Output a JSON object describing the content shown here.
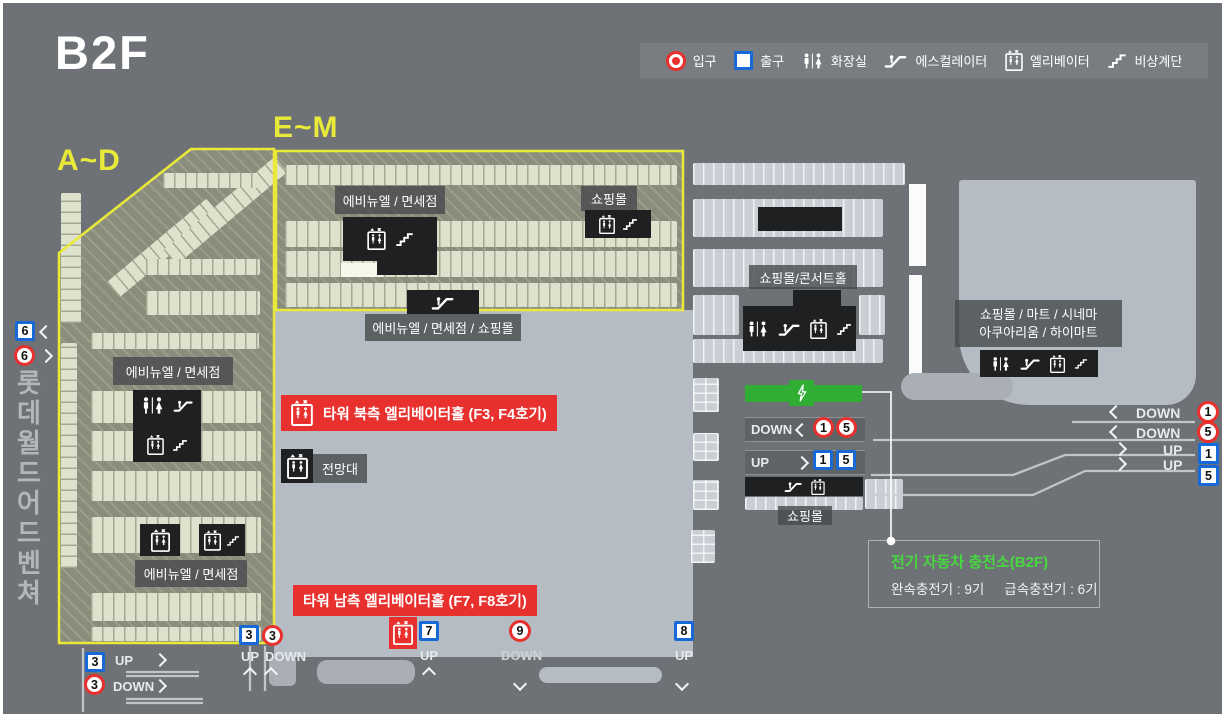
{
  "floor": "B2F",
  "legend": {
    "entrance": "입구",
    "exit": "출구",
    "restroom": "화장실",
    "escalator": "에스컬레이터",
    "elevator": "엘리베이터",
    "stairs": "비상계단"
  },
  "zones": {
    "ad": "A~D",
    "em": "E~M"
  },
  "side_text": "롯데 월드 어드벤쳐",
  "labels": {
    "em_avenuel": "에비뉴엘 / 면세점",
    "em_mall": "쇼핑몰",
    "em_below": "에비뉴엘 / 면세점 / 쇼핑몰",
    "ad_avenuel_top": "에비뉴엘 / 면세점",
    "ad_avenuel_bottom": "에비뉴엘 / 면세점",
    "tower_north": "타워 북측 엘리베이터홀 (F3, F4호기)",
    "observatory": "전망대",
    "tower_south": "타워 남측 엘리베이터홀 (F7, F8호기)",
    "mall_concert": "쇼핑몰/콘서트홀",
    "mall_mart_line1": "쇼핑몰 / 마트 / 시네마",
    "mall_mart_line2": "아쿠아리움 / 하이마트",
    "center_mall": "쇼핑몰"
  },
  "directions": {
    "up": "UP",
    "down": "DOWN"
  },
  "markers": {
    "left_exit_6": "6",
    "left_entrance_6": "6",
    "bl_exit_3": "3",
    "bl_entrance_3": "3",
    "mid_exit_3": "3",
    "mid_entrance_3": "3",
    "south_exit_7": "7",
    "center_entrance_9": "9",
    "right_exit_8": "8",
    "bar_down_1": "1",
    "bar_down_5": "5",
    "bar_up_1": "1",
    "bar_up_5": "5",
    "edge_down_1": "1",
    "edge_down_5": "5",
    "edge_up_1": "1",
    "edge_up_5": "5"
  },
  "ev": {
    "title": "전기 자동차 충전소(B2F)",
    "slow": "완속충전기 : 9기",
    "fast": "급속충전기 : 6기"
  },
  "colors": {
    "entrance_red": "#e8312e",
    "exit_blue": "#1769d6",
    "zone_yellow": "#e9e93a",
    "ev_green": "#2fae33",
    "ev_text_green": "#46d83e"
  }
}
